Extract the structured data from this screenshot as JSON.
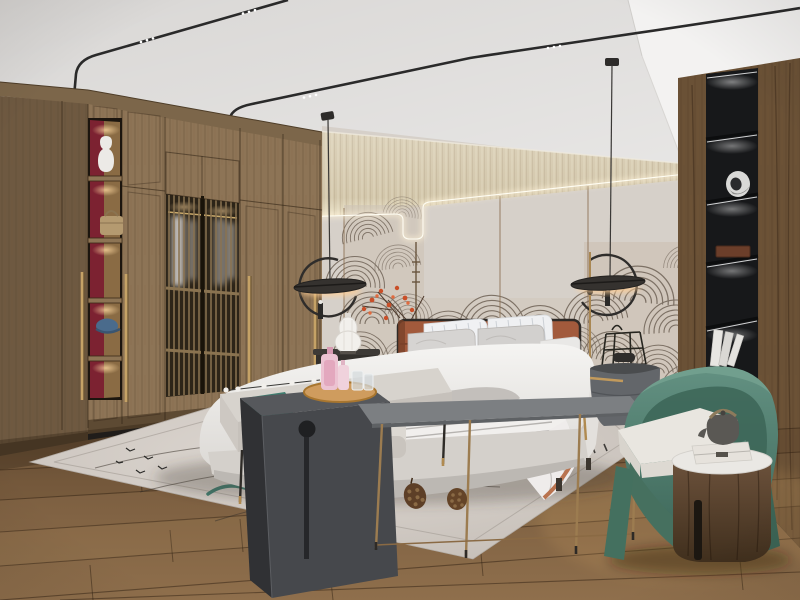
{
  "scene": {
    "description": "photorealistic 3D render of a modern Chinese style bedroom interior",
    "room": "bedroom",
    "visible_text": "none"
  },
  "palette": {
    "ceiling": "#d9d7d5",
    "beam_white": "#f3f2f1",
    "cove_cream": "#d7cbb2",
    "wall_panel": "#d6d0c9",
    "mural_line": "#7d7165",
    "wardrobe_front": "#8d7456",
    "wardrobe_side": "#6e5941",
    "red_niche": "#7c2231",
    "brass": "#c5a266",
    "shelf_black": "#17181a",
    "column_wood": "#6a5136",
    "rug": "#d3ccc6",
    "headboard_terracotta": "#a25a3c",
    "bedding_white": "#f2f1ef",
    "teal_accent": "#3f7d70",
    "charcoal": "#46484c",
    "chair_green": "#527f70",
    "drum_wood": "#5a4430",
    "lamp_black": "#2f2d2b",
    "led_warm": "#ffd9a0",
    "floor_wood": "#7c5f41"
  },
  "objects": [
    {
      "id": "wardrobe",
      "label": "oak wardrobe wall with lattice doors"
    },
    {
      "id": "display-niches",
      "label": "lit display shelves with vase, handbag and cap"
    },
    {
      "id": "ceiling-tracks",
      "label": "black magnetic track lights bending down the wall"
    },
    {
      "id": "pendant-lamp-left",
      "label": "disc pendant lamp with C-shaped arm"
    },
    {
      "id": "pendant-lamp-right",
      "label": "disc pendant lamp with C-shaped arm"
    },
    {
      "id": "headboard-wall",
      "label": "panelled wall with engraved wave mural and LED contour"
    },
    {
      "id": "bed",
      "label": "upholstered bed with terracotta leather headboard"
    },
    {
      "id": "bench",
      "label": "fabric bench with teal throw"
    },
    {
      "id": "charcoal-waterfall-table",
      "label": "charcoal waterfall side table with tray"
    },
    {
      "id": "console-table",
      "label": "thin grey console table on slender legs"
    },
    {
      "id": "ottoman",
      "label": "white ottoman stool"
    },
    {
      "id": "nightstand-left",
      "label": "dark nightstand with white gourd lamp"
    },
    {
      "id": "nightstand-right",
      "label": "grey drum nightstand with brass handle and wire lantern"
    },
    {
      "id": "armchair",
      "label": "green barrel armchair with white cushion"
    },
    {
      "id": "drum-table",
      "label": "walnut drum table with marble top and teapot"
    },
    {
      "id": "bookshelf-column",
      "label": "dark walnut column with black lit book niches"
    },
    {
      "id": "area-rug",
      "label": "light rug with ink arc pattern and pine cones"
    },
    {
      "id": "wood-floor",
      "label": "wide plank oak floor"
    }
  ]
}
